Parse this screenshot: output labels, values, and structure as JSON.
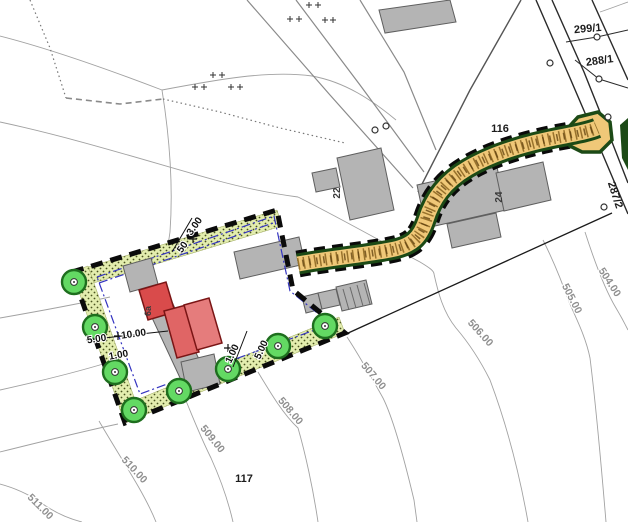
{
  "map": {
    "type": "cadastral-site-plan",
    "palette": {
      "contour_gray": "#a0a0a0",
      "road_dark": "#2a2a2a",
      "building_gray": "#b4b4b4",
      "building_outline": "#5f5f5f",
      "proposed_red": "#dd5757",
      "proposed_red_dark": "#7a1515",
      "planting_strip": "#e3edae",
      "tree_green": "#63d963",
      "tree_ring": "#1e6e1e",
      "driveway_tan": "#f0c878",
      "driveway_edge_green": "#1c4a16",
      "boundary_black": "#0b0b0b",
      "setback_blue": "#3434c0"
    },
    "labels": {
      "parcels": [
        {
          "text": "299/1",
          "x": 588,
          "y": 32,
          "rot": -5
        },
        {
          "text": "288/1",
          "x": 600,
          "y": 64,
          "rot": -8
        },
        {
          "text": "287/2",
          "x": 612,
          "y": 196,
          "rot": 72
        },
        {
          "text": "116",
          "x": 500,
          "y": 132,
          "rot": 0
        },
        {
          "text": "117",
          "x": 244,
          "y": 482,
          "rot": 0
        }
      ],
      "buildings": [
        {
          "text": "22",
          "x": 340,
          "y": 193,
          "rot": -90
        },
        {
          "text": "24",
          "x": 502,
          "y": 197,
          "rot": -90
        },
        {
          "text": "6a",
          "x": 151,
          "y": 311,
          "rot": -90,
          "color": "#5c1212",
          "size": 9
        }
      ],
      "contours": [
        {
          "text": "504.00",
          "x": 607,
          "y": 284,
          "rot": 57
        },
        {
          "text": "505.00",
          "x": 569,
          "y": 300,
          "rot": 63
        },
        {
          "text": "506.00",
          "x": 478,
          "y": 335,
          "rot": 48
        },
        {
          "text": "507.00",
          "x": 371,
          "y": 378,
          "rot": 50
        },
        {
          "text": "508.00",
          "x": 288,
          "y": 413,
          "rot": 50
        },
        {
          "text": "509.00",
          "x": 210,
          "y": 441,
          "rot": 51
        },
        {
          "text": "510.00",
          "x": 132,
          "y": 472,
          "rot": 47
        },
        {
          "text": "511.00",
          "x": 38,
          "y": 509,
          "rot": 45
        }
      ],
      "dimensions": [
        {
          "text": "3.00",
          "x": 197,
          "y": 228,
          "rot": -55
        },
        {
          "text": "50",
          "x": 185,
          "y": 249,
          "rot": -55
        },
        {
          "text": "5.00",
          "x": 97,
          "y": 342,
          "rot": -8
        },
        {
          "text": "10.00",
          "x": 134,
          "y": 337,
          "rot": -8
        },
        {
          "text": "1.00",
          "x": 119,
          "y": 358,
          "rot": -10
        },
        {
          "text": "1.00",
          "x": 235,
          "y": 355,
          "rot": -65
        },
        {
          "text": "5.00",
          "x": 264,
          "y": 351,
          "rot": -65
        }
      ]
    },
    "features": {
      "trees": [
        [
          74,
          282
        ],
        [
          95,
          327
        ],
        [
          115,
          372
        ],
        [
          134,
          410
        ],
        [
          179,
          391
        ],
        [
          228,
          369
        ],
        [
          278,
          346
        ],
        [
          325,
          326
        ]
      ],
      "survey_points": [
        [
          550,
          63
        ],
        [
          597,
          37
        ],
        [
          599,
          79
        ],
        [
          608,
          117
        ],
        [
          604,
          207
        ],
        [
          375,
          130
        ],
        [
          386,
          126
        ]
      ],
      "cross_marks": [
        [
          290,
          19
        ],
        [
          299,
          19
        ],
        [
          325,
          20
        ],
        [
          333,
          20
        ],
        [
          309,
          5
        ],
        [
          318,
          5
        ],
        [
          213,
          75
        ],
        [
          222,
          75
        ],
        [
          195,
          87
        ],
        [
          204,
          87
        ],
        [
          231,
          87
        ],
        [
          240,
          87
        ]
      ],
      "dimension_marks": [
        [
          193,
          239
        ],
        [
          118,
          336
        ],
        [
          228,
          348
        ]
      ]
    }
  }
}
